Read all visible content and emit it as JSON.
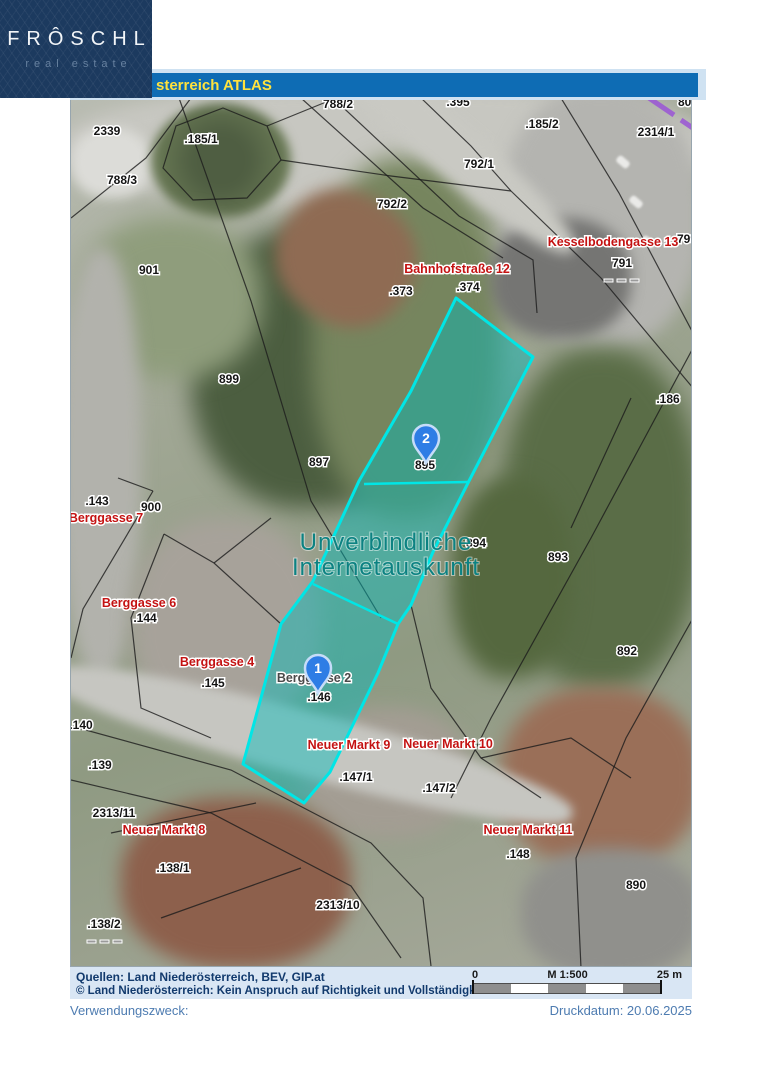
{
  "logo": {
    "brand": "FRÔSCHL",
    "tagline": "real estate"
  },
  "header": {
    "title": "sterreich ATLAS"
  },
  "map": {
    "watermark": {
      "line1": "Unverbindliche",
      "line2": "Internetauskunft",
      "x": 315,
      "y1": 452,
      "y2": 477
    },
    "markers": [
      {
        "n": "1",
        "x": 247,
        "y": 595
      },
      {
        "n": "2",
        "x": 355,
        "y": 365
      }
    ],
    "parcel_labels": [
      {
        "t": "788/2",
        "x": 267,
        "y": 10
      },
      {
        "t": ".395",
        "x": 387,
        "y": 8
      },
      {
        "t": "800",
        "x": 617,
        "y": 8
      },
      {
        "t": "2339",
        "x": 36,
        "y": 37
      },
      {
        "t": ".185/1",
        "x": 130,
        "y": 45
      },
      {
        "t": ".185/2",
        "x": 471,
        "y": 30
      },
      {
        "t": "2314/1",
        "x": 585,
        "y": 38
      },
      {
        "t": "788/3",
        "x": 51,
        "y": 86
      },
      {
        "t": "792/1",
        "x": 408,
        "y": 70
      },
      {
        "t": "792/2",
        "x": 321,
        "y": 110
      },
      {
        "t": "799",
        "x": 616,
        "y": 145
      },
      {
        "t": "791",
        "x": 551,
        "y": 169
      },
      {
        "t": "901",
        "x": 78,
        "y": 176
      },
      {
        "t": ".373",
        "x": 330,
        "y": 197
      },
      {
        "t": ".374",
        "x": 397,
        "y": 193
      },
      {
        "t": "899",
        "x": 158,
        "y": 285
      },
      {
        "t": ".186",
        "x": 597,
        "y": 305
      },
      {
        "t": "897",
        "x": 248,
        "y": 368
      },
      {
        "t": "895",
        "x": 354,
        "y": 371
      },
      {
        "t": ".143",
        "x": 26,
        "y": 407
      },
      {
        "t": "900",
        "x": 80,
        "y": 413
      },
      {
        "t": "894",
        "x": 405,
        "y": 449
      },
      {
        "t": "893",
        "x": 487,
        "y": 463
      },
      {
        "t": ".144",
        "x": 74,
        "y": 524
      },
      {
        "t": "892",
        "x": 556,
        "y": 557
      },
      {
        "t": ".145",
        "x": 142,
        "y": 589
      },
      {
        "t": ".146",
        "x": 248,
        "y": 603
      },
      {
        "t": ".140",
        "x": 10,
        "y": 631
      },
      {
        "t": ".139",
        "x": 29,
        "y": 671
      },
      {
        "t": ".147/1",
        "x": 285,
        "y": 683
      },
      {
        "t": ".147/2",
        "x": 368,
        "y": 694
      },
      {
        "t": "2313/11",
        "x": 43,
        "y": 719
      },
      {
        "t": ".148",
        "x": 447,
        "y": 760
      },
      {
        "t": ".138/1",
        "x": 102,
        "y": 774
      },
      {
        "t": "890",
        "x": 565,
        "y": 791
      },
      {
        "t": "2313/10",
        "x": 267,
        "y": 811
      },
      {
        "t": ".138/2",
        "x": 33,
        "y": 830
      }
    ],
    "street_labels": [
      {
        "t": "Kesselbodengasse 13",
        "x": 542,
        "y": 148
      },
      {
        "t": "Bahnhofstraße 12",
        "x": 386,
        "y": 175
      },
      {
        "t": "Berggasse 7",
        "x": 35,
        "y": 424
      },
      {
        "t": "Berggasse 6",
        "x": 68,
        "y": 509
      },
      {
        "t": "Berggasse 4",
        "x": 146,
        "y": 568
      },
      {
        "t": "Neuer Markt 9",
        "x": 278,
        "y": 651
      },
      {
        "t": "Neuer Markt 10",
        "x": 377,
        "y": 650
      },
      {
        "t": "Neuer Markt 8",
        "x": 93,
        "y": 736
      },
      {
        "t": "Neuer Markt 11",
        "x": 457,
        "y": 736
      }
    ],
    "address_labels": [
      {
        "t": "Berggasse 2",
        "x": 243,
        "y": 584
      }
    ]
  },
  "footer": {
    "sources": "Quellen:  Land Niederösterreich, BEV, GIP.at",
    "disclaimer": "© Land Niederösterreich: Kein Anspruch auf Richtigkeit und Vollständigkeit!",
    "scale": {
      "zero": "0",
      "ratio": "M 1:500",
      "max": "25 m"
    }
  },
  "meta": {
    "purpose": "Verwendungszweck:",
    "print_date": "Druckdatum: 20.06.2025"
  },
  "colors": {
    "logo_bg": "#1c3a5f",
    "logo_tagline": "#66809f",
    "header_bar": "#0e6cb4",
    "header_text": "#ffe23d",
    "street_red": "#c41212",
    "watermark": "#0c8282",
    "poly_stroke": "#00e6e6",
    "poly_fill": "rgba(0,187,187,0.45)",
    "marker_blue": "#2e7de5",
    "footer_bg": "#d9e6f4",
    "footer_text": "#123a6d",
    "meta_text": "#4e7cb1"
  }
}
